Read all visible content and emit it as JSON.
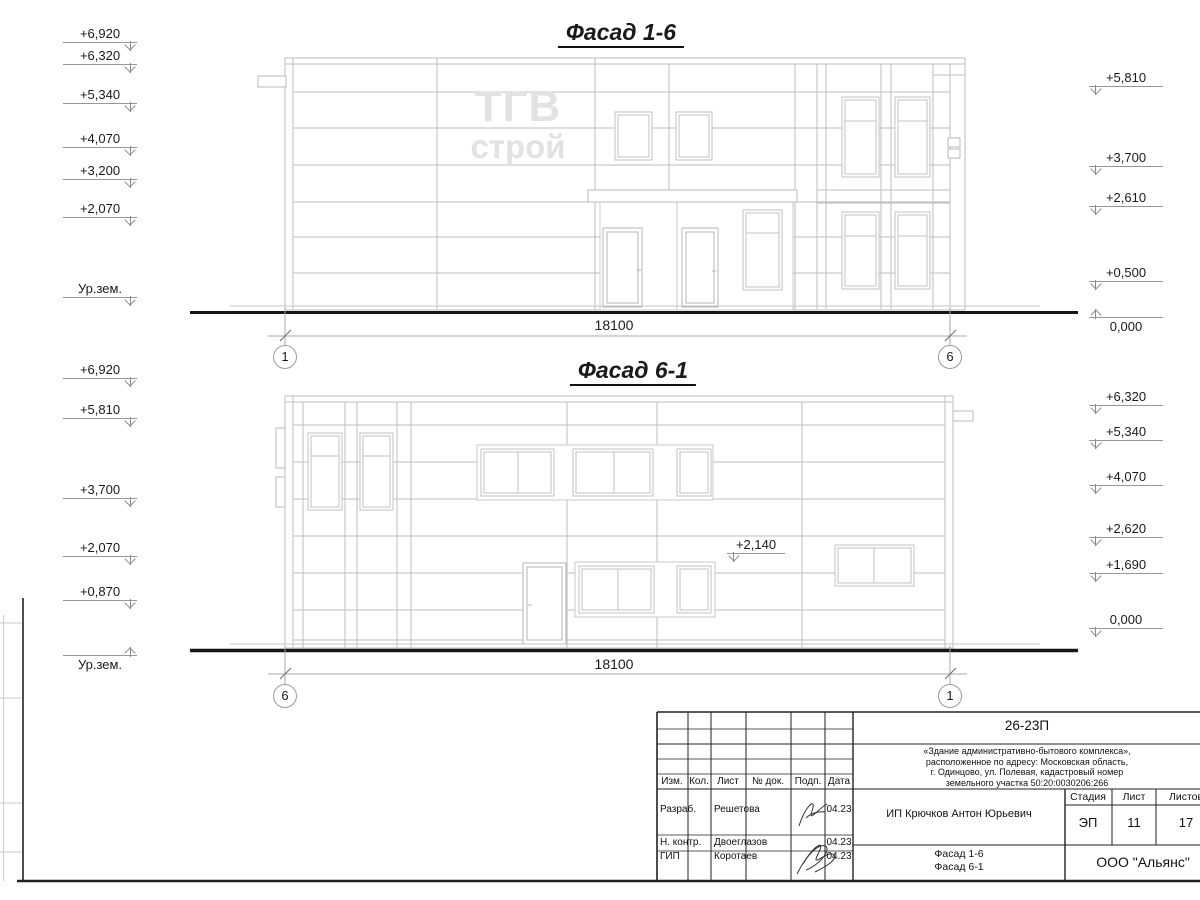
{
  "f1": {
    "title": "Фасад 1-6",
    "dimension": "18100",
    "axis_left": "1",
    "axis_right": "6",
    "logo_line1": "ТГВ",
    "logo_line2": "строй",
    "left_marks": [
      "+6,920",
      "+6,320",
      "+5,340",
      "+4,070",
      "+3,200",
      "+2,070",
      "Ур.зем."
    ],
    "right_marks": [
      "+5,810",
      "+3,700",
      "+2,610",
      "+0,500",
      "0,000"
    ]
  },
  "f2": {
    "title": "Фасад 6-1",
    "dimension": "18100",
    "axis_left": "6",
    "axis_right": "1",
    "wall_mark": "+2,140",
    "left_marks": [
      "+6,920",
      "+5,810",
      "+3,700",
      "+2,070",
      "+0,870",
      "Ур.зем."
    ],
    "right_marks": [
      "+6,320",
      "+5,340",
      "+4,070",
      "+2,620",
      "+1,690",
      "0,000"
    ]
  },
  "titleblock": {
    "doc_number": "26-23П",
    "description_lines": [
      "«Здание административно-бытового комплекса»,",
      "расположенное по адресу: Московская область,",
      "г. Одинцово, ул. Полевая, кадастровый номер",
      "земельного участка 50:20:0030206:266"
    ],
    "header_cols": [
      "Изм.",
      "Кол.",
      "Лист",
      "№ док.",
      "Подп.",
      "Дата"
    ],
    "rows": [
      {
        "role": "Разраб.",
        "name": "Решетова",
        "date": "04.23"
      },
      {
        "role": "Н. контр.",
        "name": "Двоеглазов",
        "date": "04.23"
      },
      {
        "role": "ГИП",
        "name": "Коротаев",
        "date": "04.23"
      }
    ],
    "client": "ИП Крючков Антон Юрьевич",
    "stage_label": "Стадия",
    "sheet_label": "Лист",
    "sheets_label": "Листов",
    "stage": "ЭП",
    "sheet_no": "11",
    "sheets_total": "17",
    "drawing_title_line1": "Фасад 1-6",
    "drawing_title_line2": "Фасад 6-1",
    "company": "ООО \"Альянс\""
  }
}
